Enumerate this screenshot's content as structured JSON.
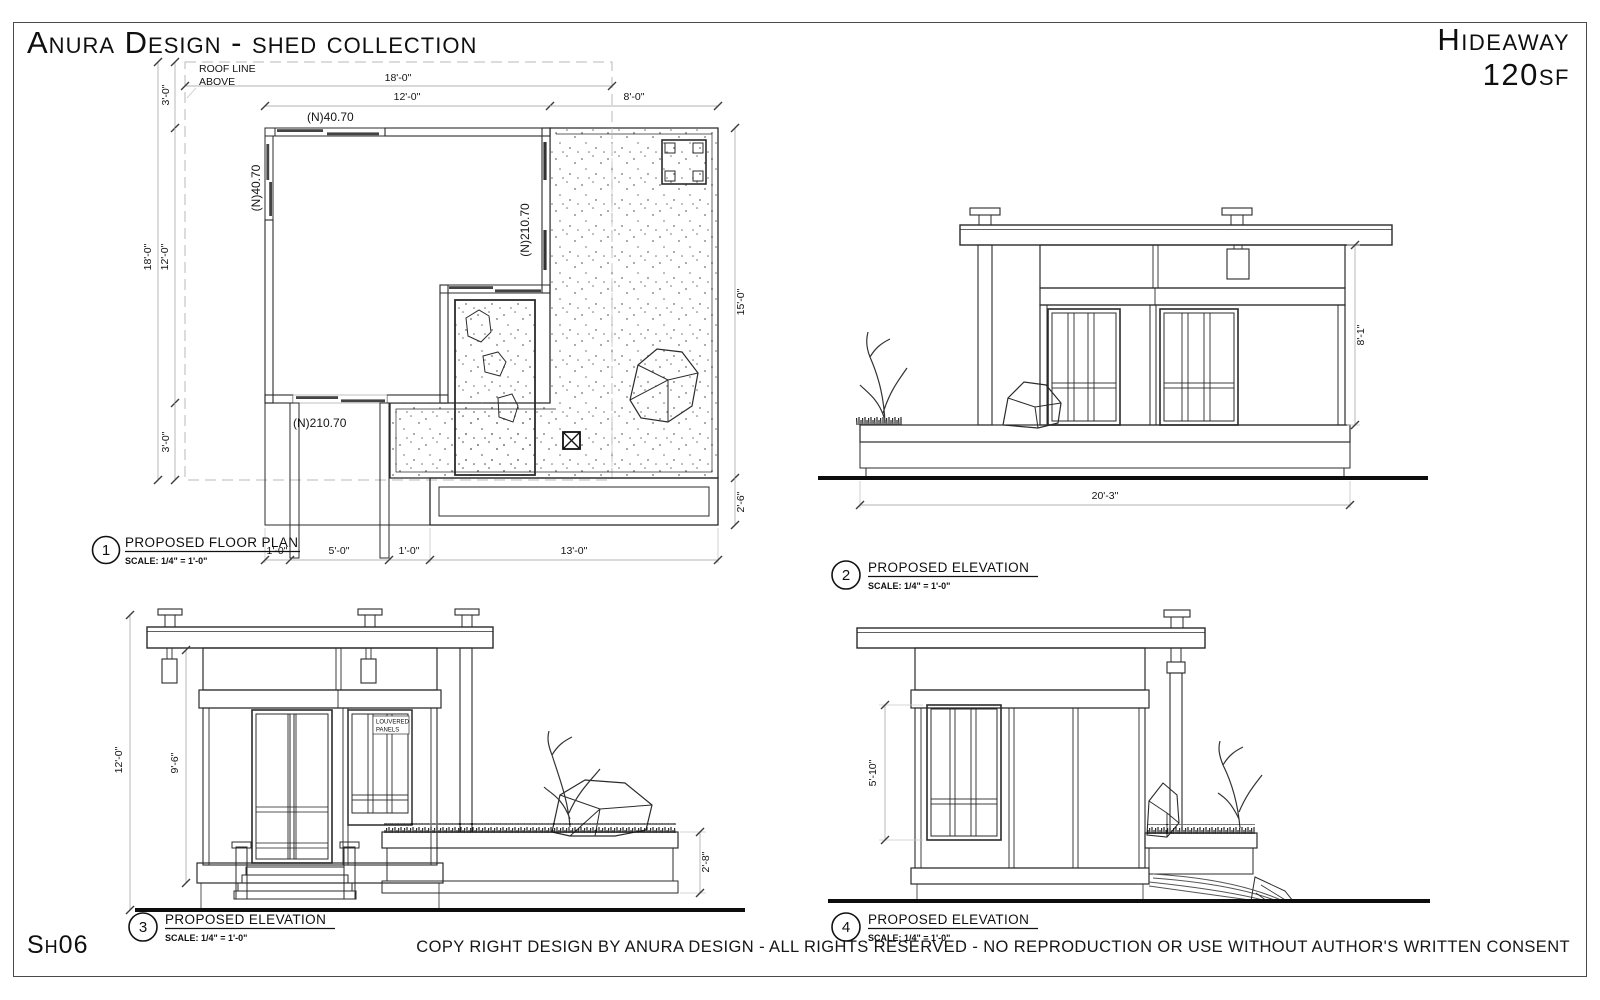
{
  "sheet": {
    "title": "Anura Design - shed collection",
    "model": "Hideaway",
    "area": "120sf",
    "sheet_number": "Sh06",
    "copyright": "COPY RIGHT DESIGN BY ANURA DESIGN - ALL RIGHTS RESERVED - NO REPRODUCTION OR USE WITHOUT AUTHOR'S WRITTEN CONSENT"
  },
  "floor_plan": {
    "number": "1",
    "title": "PROPOSED FLOOR PLAN",
    "scale": "SCALE: 1/4\" = 1'-0\"",
    "roof_note_line1": "ROOF LINE",
    "roof_note_line2": "ABOVE",
    "labels": {
      "top_wall": "(N)40.70",
      "left_wall": "(N)40.70",
      "right_wall": "(N)210.70",
      "bottom_wall": "(N)210.70"
    },
    "dims": {
      "roof_width": "18'-0\"",
      "room_width": "12'-0\"",
      "deck_width": "8'-0\"",
      "roof_overhang_top": "3'-0\"",
      "roof_depth": "18'-0\"",
      "room_depth": "12'-0\"",
      "roof_overhang_bottom": "3'-0\"",
      "deck_depth": "15'-0\"",
      "planter_depth": "2'-6\"",
      "walk_left": "1'-0\"",
      "walk_width": "5'-0\"",
      "walk_right": "1'-0\"",
      "deck_front": "13'-0\""
    }
  },
  "elevation_2": {
    "number": "2",
    "title": "PROPOSED ELEVATION",
    "scale": "SCALE: 1/4\" = 1'-0\"",
    "dims": {
      "width": "20'-3\"",
      "height": "8'-1\""
    }
  },
  "elevation_3": {
    "number": "3",
    "title": "PROPOSED ELEVATION",
    "scale": "SCALE: 1/4\" = 1'-0\"",
    "note_line1": "LOUVERED",
    "note_line2": "PANELS",
    "dims": {
      "height": "12'-0\"",
      "wall_height": "9'-6\"",
      "planter_height": "2'-8\""
    }
  },
  "elevation_4": {
    "number": "4",
    "title": "PROPOSED ELEVATION",
    "scale": "SCALE: 1/4\" = 1'-0\"",
    "dims": {
      "window_height": "5'-10\""
    }
  },
  "colors": {
    "line": "#2b2b2b",
    "dim_line": "#b3b3b3",
    "paper": "#ffffff",
    "border": "#4a4a4a"
  }
}
